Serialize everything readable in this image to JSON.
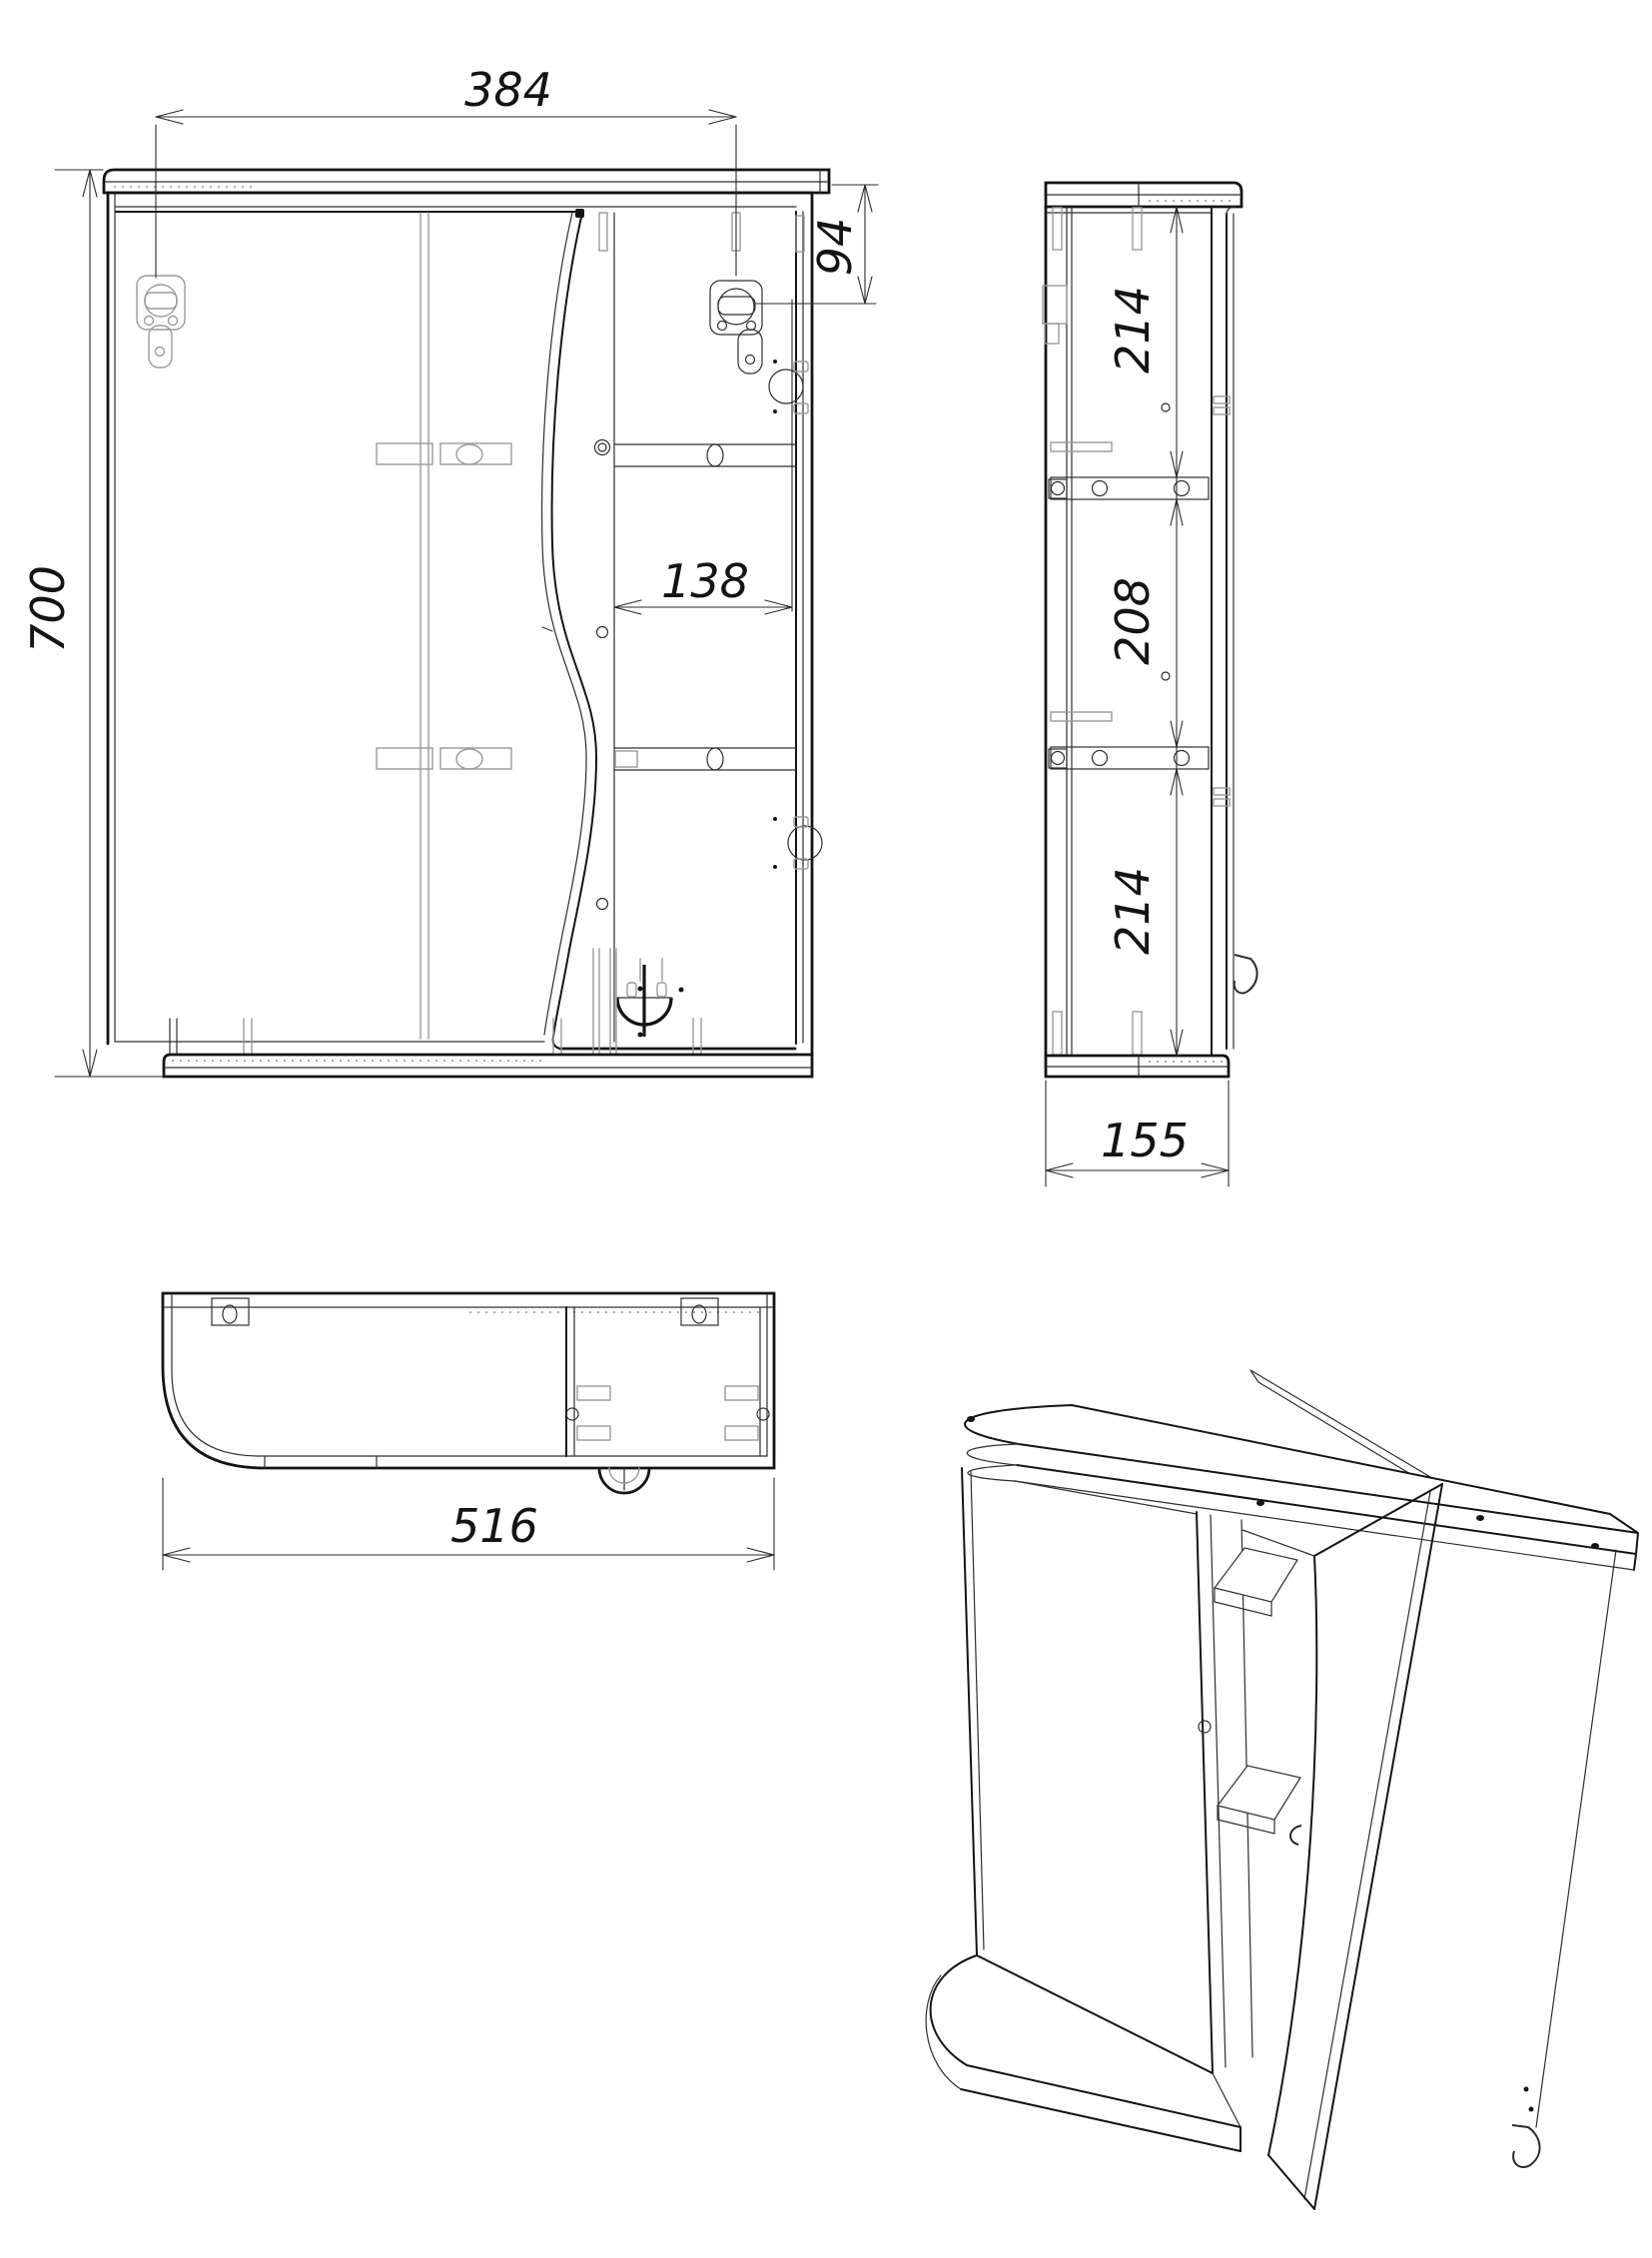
{
  "drawing": {
    "kind": "technical-drawing",
    "background": "#ffffff",
    "ink": "#141414",
    "hidden_line_color": "#9a9a9a",
    "views": {
      "front": {
        "name": "front-view",
        "dimensions": {
          "hanger_spacing": "384",
          "top_offset": "94",
          "overall_height": "700",
          "opening_width": "138"
        }
      },
      "side": {
        "name": "side-view",
        "dimensions": {
          "upper_section": "214",
          "middle_section": "208",
          "lower_section": "214",
          "depth": "155"
        }
      },
      "bottom": {
        "name": "bottom-view",
        "dimensions": {
          "overall_width": "516"
        }
      },
      "isometric": {
        "name": "isometric-view"
      }
    }
  }
}
